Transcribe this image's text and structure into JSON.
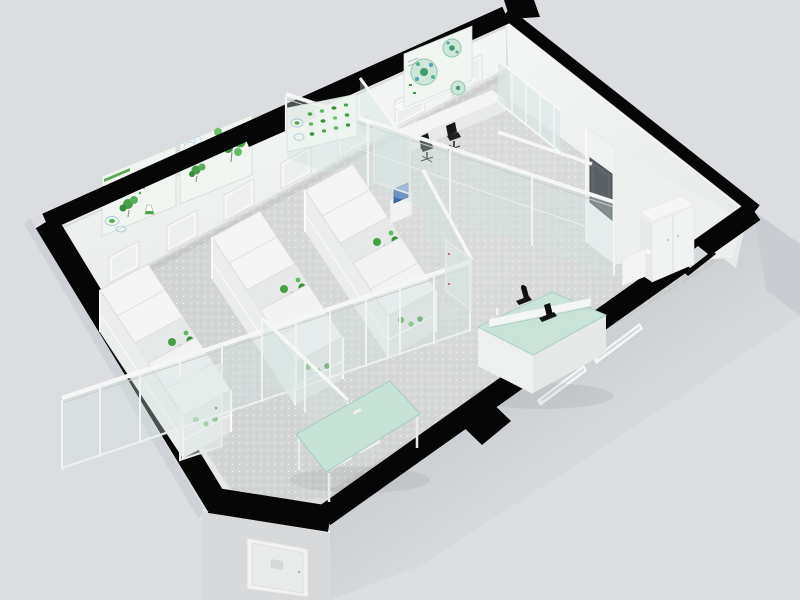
{
  "meta": {
    "title": "3D laboratory floor plan - isometric cutaway render",
    "image_type": "architectural 3D rendering, no visible text"
  },
  "palette": {
    "bg": "#dcdde0",
    "band": "#060607",
    "floor": "#d2d4d3",
    "floorSpeckLight": "#f3f4f3",
    "floorSpeckDark": "#b2b7b3",
    "wallWhite": "#f3f5f4",
    "wallShade": "#e9ecea",
    "extWall": "#d2d4d8",
    "extWallDark": "#c7cace",
    "doorWall": "#d7d9db",
    "frame": "#f5f6f5",
    "frameShadow": "#c8cdcb",
    "glassTint": "#cfe3df",
    "mint": "#c9e3d9",
    "mintTable": "#c6e1d6",
    "plantGreen": "#46a046",
    "plantGreenDark": "#3a923a",
    "plantGreenLight": "#68bf68",
    "posterBg": "#f1f5f1",
    "posterGreen": "#3f9b3f",
    "posterBlue": "#a9c9d9",
    "posterTeal": "#8fc9ae",
    "panelDark": "#5b6065",
    "chairBlack": "#1f2022",
    "equipBlack": "#141414",
    "monitorBlue": "#3e6cb0",
    "nicheInner": "#d6d9dc"
  },
  "scene": {
    "view": "isometric cutaway with thick black wall slab",
    "rooms": [
      {
        "name": "plant-culture-lab",
        "contents": [
          "three white culture racks with green plants",
          "green botanical wall charts",
          "back-wall windows"
        ]
      },
      {
        "name": "glass-walled-office",
        "contents": [
          "white desk",
          "two black office chairs",
          "blue-screen monitor cart"
        ]
      },
      {
        "name": "instrument-area",
        "contents": [
          "island bench with mint glass top",
          "two black microscopes",
          "mint green table with two white stools"
        ]
      },
      {
        "name": "storage-corner",
        "contents": [
          "white double-door cabinet",
          "dark gray wall panel",
          "recessed wall niche"
        ]
      }
    ],
    "posters": {
      "count": 4,
      "theme": "green botany / microbiology wall charts"
    },
    "doors": {
      "exterior_door": 1,
      "glass_doors": 3
    },
    "windows": {
      "back_wall": 7,
      "front_wall_slots": 2
    }
  }
}
